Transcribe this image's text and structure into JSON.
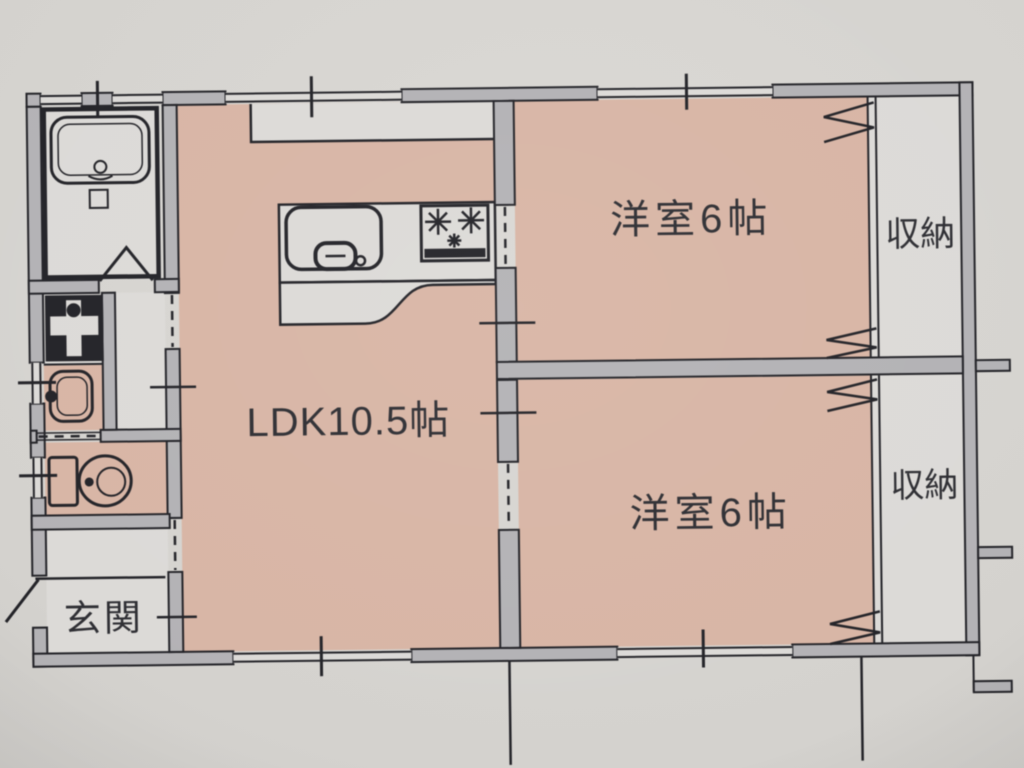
{
  "page": {
    "type": "floor-plan-photo"
  },
  "plan": {
    "rooms": {
      "ldk": {
        "label": "LDK10.5帖"
      },
      "bedroom_upper": {
        "label": "洋室6帖"
      },
      "bedroom_lower": {
        "label": "洋室6帖"
      },
      "closet_upper": {
        "label": "収納"
      },
      "closet_lower": {
        "label": "収納"
      },
      "entrance": {
        "label": "玄関"
      }
    },
    "icons": [
      "bathtub-icon",
      "shower-box-icon",
      "bath-door-icon",
      "washing-machine-pan-icon",
      "washbasin-icon",
      "toilet-icon",
      "kitchen-sink-icon",
      "stove-icon",
      "entrance-door-icon",
      "folding-door-icon",
      "sliding-opening-dashes",
      "window-symbol"
    ],
    "colors": {
      "paper": "#d4d2ce",
      "room-fill": "#d9b5a4",
      "floor-light": "#dcdad7",
      "wall-fill": "#b3b2b5",
      "line": "#232328",
      "text": "#2e2e33"
    }
  }
}
